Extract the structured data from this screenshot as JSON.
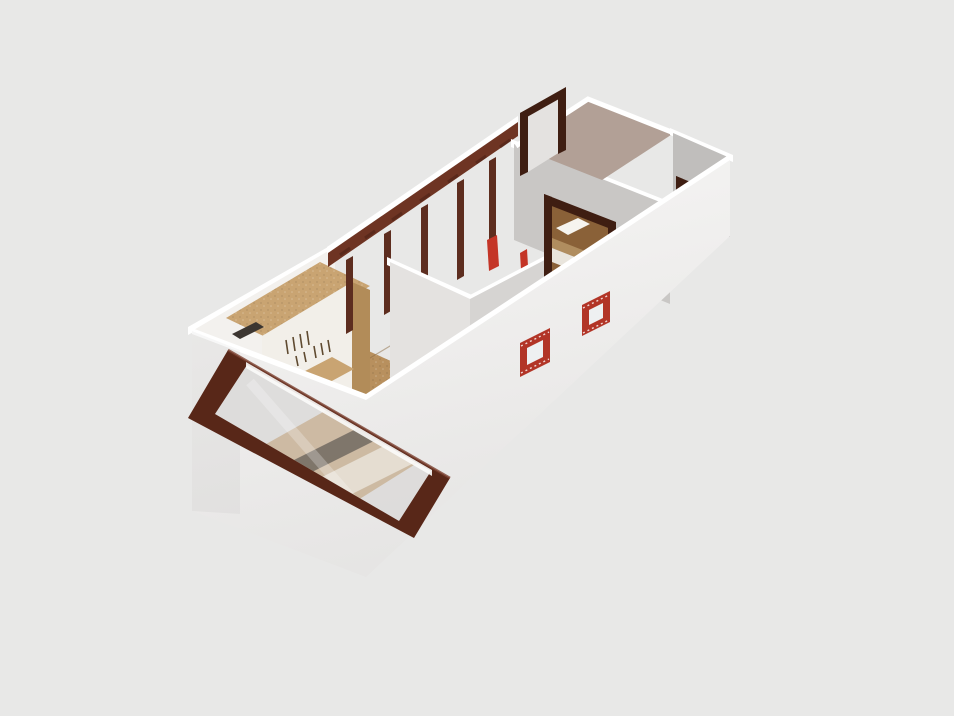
{
  "viewport": {
    "width": 954,
    "height": 716,
    "kind": "3d-floorplan-render",
    "camera": "isometric-top-down"
  },
  "scene": {
    "objects": [
      {
        "id": "left-bedroom",
        "label": "bedroom with wardrobe, bed and casement window"
      },
      {
        "id": "wardrobe",
        "label": "open wardrobe with hanging clothes and shelf"
      },
      {
        "id": "bed-left",
        "label": "white bed with dark stripe"
      },
      {
        "id": "casement-window",
        "label": "large mahogany-framed window"
      },
      {
        "id": "stud-wall",
        "label": "open framed wall with mahogany beam and posts"
      },
      {
        "id": "bathroom",
        "label": "small middle room with spotlight on wall"
      },
      {
        "id": "hallway",
        "label": "wood-floor corridor"
      },
      {
        "id": "right-bedroom",
        "label": "bedroom seen through doorway with bed"
      },
      {
        "id": "mauve-room",
        "label": "room with mauve floor and two door openings"
      },
      {
        "id": "small-brick-windows",
        "label": "two small red-framed square windows on front wall"
      },
      {
        "id": "exterior-walls",
        "label": "white exterior wall skirt"
      }
    ]
  },
  "colors": {
    "background": "#e8e8e7",
    "white": "#ffffff",
    "wallInteriorWhite": "#f3f1ee",
    "wallLight": "#e4e2e0",
    "wallMid": "#d6d4d2",
    "wallGray": "#c9c7c5",
    "wallGrayDark": "#c0bebc",
    "skirtLight": "#f7f6f5",
    "skirtDark": "#e5e4e3",
    "floorOak": "#b8905e",
    "floorOakDark": "#8a6138",
    "pinkFloor": "#b2a096",
    "beamBrown": "#6e3423",
    "studBrown": "#5d2d1f",
    "frameDark": "#582718",
    "frameDarker": "#3f1e12",
    "brightRed": "#c43527",
    "brickRed": "#b23527",
    "wardrobeWood": "#c9a472",
    "wardrobeWoodDark": "#b28c59",
    "wardrobePanel": "#f2efe9",
    "bedWhite": "#fafaf8",
    "bedStripe": "#54514d",
    "bedStripeLight": "#8a8782",
    "bedFrameDark": "#403e3b",
    "pillowWhite": "#f6f4ef",
    "headboardWood": "#b08d5f",
    "mattressCream": "#e9e5dd",
    "doorOpening": "#eceae7",
    "glass": "#dddcdb",
    "windowInnerLight": "#eef0f1"
  }
}
